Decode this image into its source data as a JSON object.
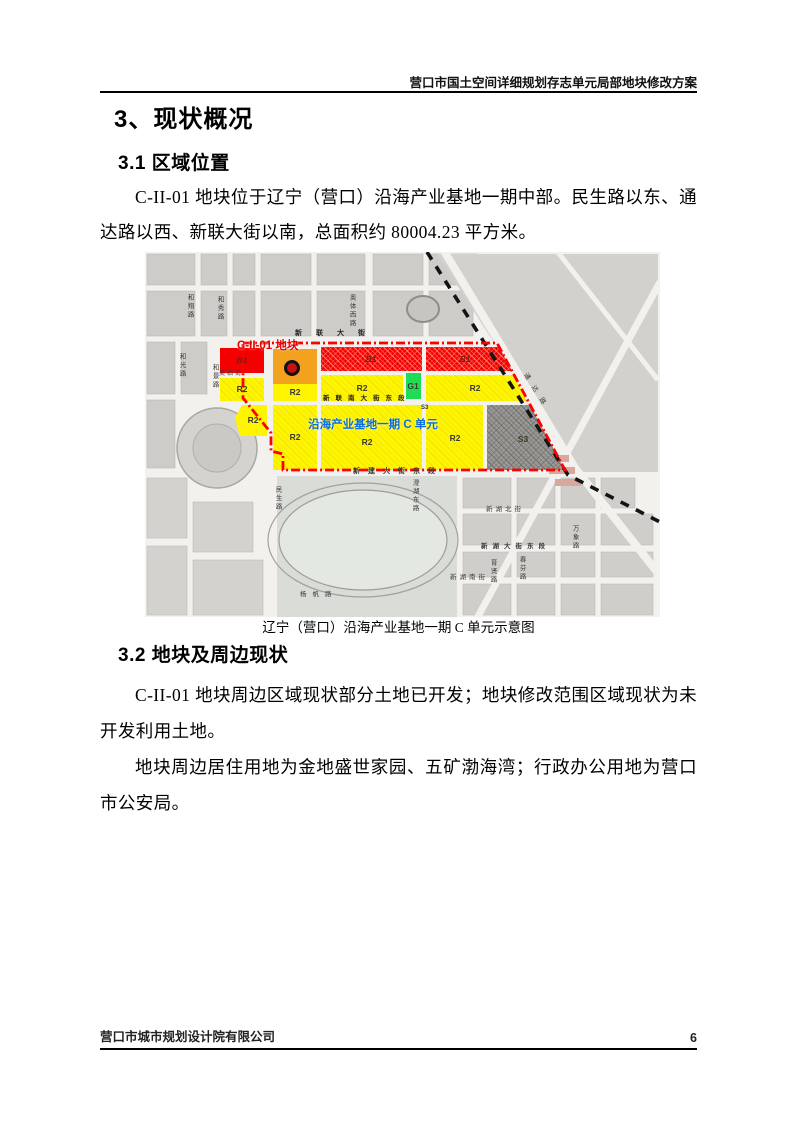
{
  "page": {
    "header": "营口市国土空间详细规划存志单元局部地块修改方案",
    "footer_left": "营口市城市规划设计院有限公司",
    "page_number": "6"
  },
  "headings": {
    "h1": "3、现状概况",
    "h2_1": "3.1 区域位置",
    "h2_2": "3.2 地块及周边现状"
  },
  "paragraphs": {
    "p1": "C-II-01 地块位于辽宁（营口）沿海产业基地一期中部。民生路以东、通达路以西、新联大街以南，总面积约 80004.23 平方米。",
    "p2": "C-II-01 地块周边区域现状部分土地已开发；地块修改范围区域现状为未开发利用土地。",
    "p3": "地块周边居住用地为金地盛世家园、五矿渤海湾；行政办公用地为营口市公安局。"
  },
  "map": {
    "caption": "辽宁（营口）沿海产业基地一期 C 单元示意图",
    "parcel_label": "C-II-01 地块",
    "unit_label": "沿海产业基地一期 C 单元",
    "colors": {
      "commercial_red": "#f50000",
      "parcel_orange": "#f2a21e",
      "residential_yellow": "#fff500",
      "green_g1": "#1edd55",
      "transport_gray": "#9b9a96",
      "boundary_red": "#ff0000",
      "railway_black": "#141414"
    },
    "zones": [
      {
        "id": "b1-left",
        "label": "B1"
      },
      {
        "id": "b1-mid",
        "label": "B1"
      },
      {
        "id": "b1-right",
        "label": "B1"
      },
      {
        "id": "r2-a",
        "label": "R2"
      },
      {
        "id": "r2-b",
        "label": "R2"
      },
      {
        "id": "r2-c",
        "label": "R2"
      },
      {
        "id": "r2-d",
        "label": "R2"
      },
      {
        "id": "r2-e",
        "label": "R2"
      },
      {
        "id": "r2-f",
        "label": "R2"
      },
      {
        "id": "r2-g",
        "label": "R2"
      },
      {
        "id": "r2-h",
        "label": "R2"
      },
      {
        "id": "g1",
        "label": "G1"
      },
      {
        "id": "s3",
        "label": "S3"
      },
      {
        "id": "s3-corner",
        "label": "S3"
      }
    ],
    "roads": [
      {
        "name": "和翔路"
      },
      {
        "name": "和秀路"
      },
      {
        "name": "奥体西路"
      },
      {
        "name": "和光路"
      },
      {
        "name": "和景路"
      },
      {
        "name": "美临街"
      },
      {
        "name": "新联大街"
      },
      {
        "name": "新联南大街东段"
      },
      {
        "name": "新建大街东段"
      },
      {
        "name": "民生路"
      },
      {
        "name": "澄湖东路"
      },
      {
        "name": "杨帆路"
      },
      {
        "name": "新湖北街"
      },
      {
        "name": "新湖大街东段"
      },
      {
        "name": "新湖南街"
      },
      {
        "name": "育贤路"
      },
      {
        "name": "春芬路"
      },
      {
        "name": "万象路"
      },
      {
        "name": "通达路"
      }
    ]
  }
}
